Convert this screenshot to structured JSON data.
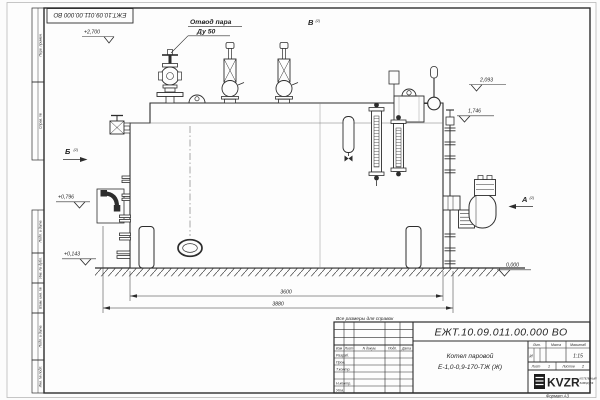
{
  "sheet": {
    "doc_number": "ЕЖТ.10.09.011.00.000  ВО",
    "format_label": "Формат А3",
    "reference_note": "Все размеры для справок"
  },
  "margin_columns": {
    "perv_primen": "Перв. примен.",
    "sprav_no": "Справ. №",
    "podp_data1": "Подп. и дата",
    "inv_dubl": "Инв. № дубл.",
    "vzam_inv": "Взам. инв. №",
    "podp_data2": "Подп. и дата",
    "inv_podl": "Инв. № подл."
  },
  "title_block": {
    "cols": {
      "izm": "Изм",
      "list": "Лист",
      "doc": "N докум.",
      "podp": "Подп.",
      "data": "Дата"
    },
    "rows": {
      "razrab": "Разраб.",
      "prov": "Пров.",
      "tkontr": "Т.контр.",
      "nkontr": "Н.контр.",
      "utv": "Утв."
    },
    "product_line1": "Котел паровой",
    "product_line2": "Е-1,0-0,9-170-ТЖ (Ж)",
    "lit_label": "Лит.",
    "mass_label": "Масса",
    "scale_label": "Масштаб",
    "lit_value": "И",
    "scale_value": "1:15",
    "sheet_label": "Лист",
    "sheet_value": "1",
    "sheets_label": "Листов",
    "sheets_value": "2",
    "logo_text": "KVZR",
    "logo_tagline1": "КОТЕЛЬНЫЙ",
    "logo_tagline2": "ЗАВОД РФ"
  },
  "drawing": {
    "callout_steam_line1": "Отвод пара",
    "callout_steam_line2": "Ду 50",
    "view_v": "В",
    "view_v_sub": "(2)",
    "view_b": "Б",
    "view_b_sub": "(2)",
    "view_a": "А",
    "view_a_sub": "(2)",
    "elev_top": "+2,700",
    "elev_dome": "2,093",
    "elev_pipe": "1,746",
    "elev_mid": "+0,796",
    "elev_low": "+0,143",
    "elev_ground": "0,000",
    "dim_shell": "3600",
    "dim_overall": "3880"
  },
  "colors": {
    "line": "#2d2d2d",
    "paper": "#fdfdfd",
    "frame": "#2d2d2d"
  }
}
